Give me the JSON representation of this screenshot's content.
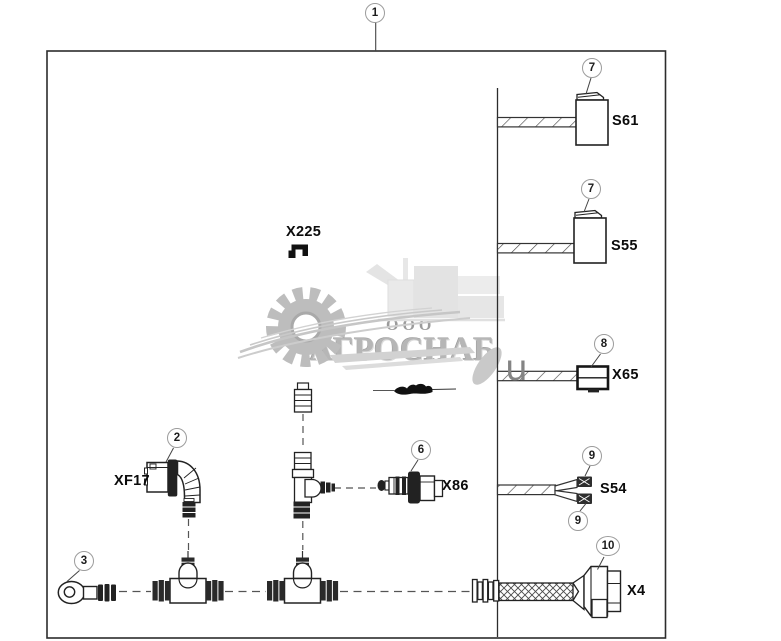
{
  "watermark": {
    "company_prefix": "ООО",
    "company_name": "АГРОСНАБ",
    "annotation_letter": "u"
  },
  "callouts": {
    "c1": "1",
    "c2": "2",
    "c3": "3",
    "c6": "6",
    "c7a": "7",
    "c7b": "7",
    "c8": "8",
    "c9a": "9",
    "c9b": "9",
    "c10": "10"
  },
  "labels": {
    "x225": "X225",
    "xf17": "XF17",
    "x86": "X86",
    "s61": "S61",
    "s55": "S55",
    "x65": "X65",
    "s54": "S54",
    "x4": "X4"
  },
  "colors": {
    "line": "#2c2c2c",
    "callout_border": "#9c9c9c",
    "watermark_gray": "#bdbdbd"
  }
}
